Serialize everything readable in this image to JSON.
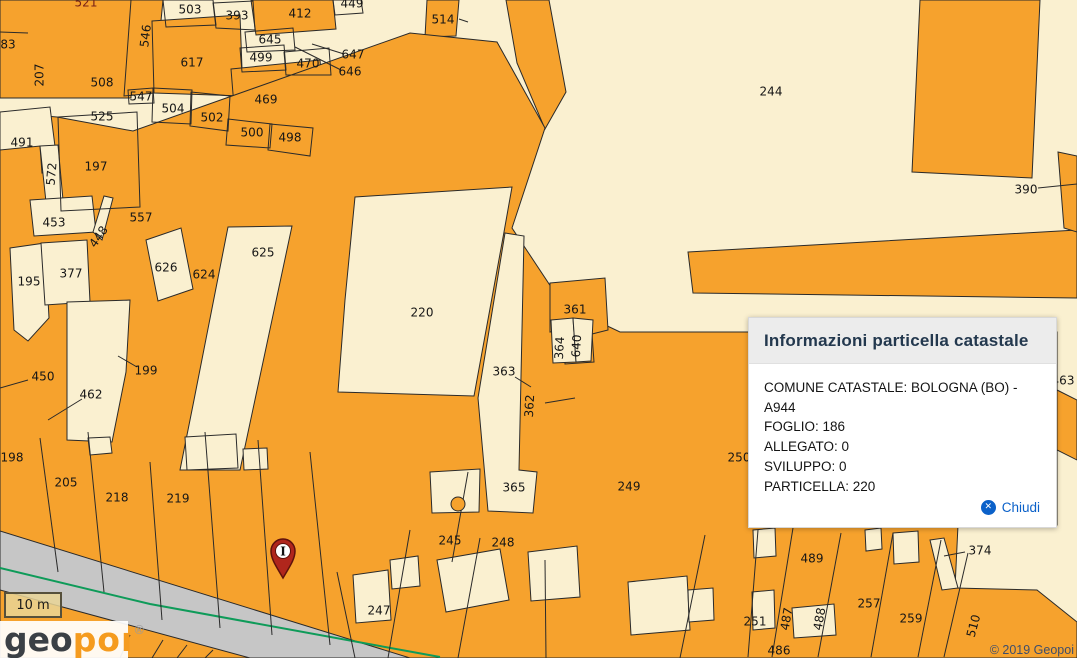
{
  "info_panel": {
    "title": "Informazioni particella catastale",
    "lines": [
      "COMUNE CATASTALE: BOLOGNA (BO) - A944",
      "FOGLIO: 186",
      "ALLEGATO: 0",
      "SVILUPPO: 0",
      "PARTICELLA: 220"
    ],
    "close_label": "Chiudi",
    "close_icon": "circle-x-icon",
    "accent_color": "#0B61C9"
  },
  "scale_bar": {
    "label": "10 m"
  },
  "logo": {
    "part1": "geo",
    "part2": "poı",
    "reg": "®"
  },
  "copyright": "© 2019 Geopoi",
  "map": {
    "colors": {
      "orange": "#F6A22D",
      "cream": "#FAF0D0",
      "stroke": "#2A2A2A",
      "road": "#C6C6C6",
      "green": "#0E9B59",
      "label": "#161616",
      "pin": "#B0261C",
      "pin_dark": "#5F120C"
    },
    "orange_polys": [
      {
        "id": "parcel-block-topleft",
        "pts": "0,0 131,0 131,98 0,98"
      },
      {
        "id": "parcel-546",
        "pts": "131,0 163,0 154,93 124,96"
      },
      {
        "id": "parcel-617",
        "pts": "152,21 240,15 243,96 154,93"
      },
      {
        "id": "parcel-412",
        "pts": "251,0 333,0 336,29 256,35"
      },
      {
        "id": "parcel-469",
        "pts": "231,69 320,60 326,127 236,131"
      },
      {
        "id": "parcel-514",
        "pts": "427,0 459,0 456,36 425,37"
      },
      {
        "id": "parcel-strip-ne",
        "pts": "506,0 549,0 566,92 545,129 517,63"
      },
      {
        "id": "parcel-main-block",
        "pts": "0,112 57,117 133,131 410,33 497,42 545,128 512,228 563,305 620,332 1057,332 1057,525 958,525 955,588 1037,590 1077,622 1077,658 0,658"
      },
      {
        "id": "parcel-band-244",
        "pts": "688,252 1077,230 1077,298 693,293"
      },
      {
        "id": "building-244",
        "pts": "920,0 1040,0 1032,178 912,172"
      },
      {
        "id": "parcel-390-edge",
        "pts": "1058,152 1077,156 1077,232 1064,228"
      },
      {
        "id": "parcel-361",
        "pts": "550,283 605,278 608,330 592,334 594,362 565,364 563,330 550,332"
      },
      {
        "id": "parcel-463-sliver",
        "pts": "1057,390 1077,400 1077,460 1057,450"
      }
    ],
    "cream_polys": [
      {
        "id": "parcel-491",
        "pts": "0,112 50,107 58,170 42,173 40,146 0,150"
      },
      {
        "id": "parcel-572",
        "pts": "40,146 58,145 63,200 46,202"
      },
      {
        "id": "parcel-453",
        "pts": "30,200 92,196 96,232 34,236"
      },
      {
        "id": "parcel-448",
        "pts": "93,232 104,196 113,198 102,240"
      },
      {
        "id": "parcel-195",
        "pts": "10,248 45,243 49,318 28,341 14,330"
      },
      {
        "id": "parcel-377",
        "pts": "41,243 87,240 90,302 45,305"
      },
      {
        "id": "building-626",
        "pts": "146,240 181,228 193,289 158,301"
      },
      {
        "id": "parcel-625",
        "pts": "228,227 292,226 240,470 180,470 194,400"
      },
      {
        "id": "parcel-199",
        "pts": "67,302 130,300 126,372 112,442 67,440"
      },
      {
        "id": "parcel-220",
        "pts": "355,197 512,187 504,232 474,396 338,392 345,300"
      },
      {
        "id": "parcel-362-365",
        "pts": "505,233 524,236 519,470 537,472 533,513 488,511 478,398"
      },
      {
        "id": "parcel-364",
        "pts": "551,320 573,318 576,362 553,363"
      },
      {
        "id": "parcel-640",
        "pts": "573,318 593,320 591,361 576,362"
      },
      {
        "id": "building-a",
        "pts": "88,438 110,437 112,453 90,455"
      },
      {
        "id": "building-b",
        "pts": "185,437 236,434 238,468 187,470"
      },
      {
        "id": "building-c",
        "pts": "243,449 267,448 268,469 244,470"
      },
      {
        "id": "building-245",
        "pts": "430,472 480,469 479,512 432,513"
      },
      {
        "id": "building-e",
        "pts": "437,560 500,549 509,600 446,612"
      },
      {
        "id": "building-f",
        "pts": "390,560 418,556 420,586 392,589"
      },
      {
        "id": "building-g",
        "pts": "353,575 388,570 391,620 356,623"
      },
      {
        "id": "building-h",
        "pts": "528,552 577,546 580,597 531,601"
      },
      {
        "id": "building-i",
        "pts": "628,582 687,576 690,630 631,635"
      },
      {
        "id": "building-j",
        "pts": "688,590 713,588 714,620 689,622"
      },
      {
        "id": "building-k",
        "pts": "753,530 775,528 776,556 754,558"
      },
      {
        "id": "building-l",
        "pts": "752,592 774,590 775,628 753,630"
      },
      {
        "id": "building-m",
        "pts": "792,608 834,604 836,635 794,638"
      },
      {
        "id": "building-n",
        "pts": "865,530 881,528 882,549 866,551"
      },
      {
        "id": "building-o",
        "pts": "893,533 918,531 919,562 894,564"
      },
      {
        "id": "parcel-374-strip",
        "pts": "930,540 944,538 958,588 942,590"
      }
    ],
    "outline_polys": [
      {
        "id": "parcel-503",
        "pts": "163,0 213,0 216,25 166,27"
      },
      {
        "id": "parcel-393",
        "pts": "213,3 253,1 255,30 216,28"
      },
      {
        "id": "parcel-645",
        "pts": "245,32 293,28 295,50 247,52"
      },
      {
        "id": "parcel-499",
        "pts": "240,48 284,45 286,70 242,72"
      },
      {
        "id": "parcel-470",
        "pts": "284,52 329,48 331,75 286,75"
      },
      {
        "id": "parcel-449",
        "pts": "333,0 361,0 363,13 335,15"
      },
      {
        "id": "parcel-547",
        "pts": "128,90 153,88 154,103 129,104"
      },
      {
        "id": "parcel-504",
        "pts": "153,88 192,90 191,124 152,122"
      },
      {
        "id": "parcel-502",
        "pts": "191,92 230,96 228,131 190,126"
      },
      {
        "id": "parcel-500",
        "pts": "228,119 272,124 270,148 226,145"
      },
      {
        "id": "parcel-498",
        "pts": "270,124 313,128 310,156 268,150"
      },
      {
        "id": "parcel-197",
        "pts": "58,117 137,112 140,207 61,211"
      }
    ],
    "lines": [
      "0,32 28,33",
      "40,438 58,572",
      "88,432 104,592",
      "150,462 162,620",
      "205,432 220,628",
      "258,440 272,635",
      "310,452 330,645",
      "337,572 355,658",
      "410,530 388,658",
      "480,538 458,658",
      "545,560 546,658",
      "468,472 452,562",
      "705,535 680,658",
      "758,530 748,657",
      "793,528 772,657",
      "841,533 818,657",
      "893,533 871,657",
      "941,540 918,657",
      "968,553 944,657",
      "130,635 120,658",
      "163,640 152,658",
      "187,645 177,658",
      "213,650 205,658",
      "344,54 312,44",
      "341,70 295,47",
      "1038,188 1077,184",
      "944,556 965,552",
      "515,377 531,387",
      "545,403 575,398",
      "137,367 118,356",
      "28,380 0,388",
      "82,399 48,420",
      "459,19 468,22"
    ],
    "road": {
      "poly": "0,531 410,658 250,658 0,590",
      "green": "0,568 150,604 440,657"
    },
    "labels": [
      {
        "t": "521",
        "x": 86,
        "y": 3,
        "c": "#7a2317"
      },
      {
        "t": "83",
        "x": 8,
        "y": 45
      },
      {
        "t": "207",
        "x": 40,
        "y": 75,
        "r": -90
      },
      {
        "t": "508",
        "x": 102,
        "y": 83
      },
      {
        "t": "546",
        "x": 146,
        "y": 36,
        "r": -83
      },
      {
        "t": "503",
        "x": 190,
        "y": 10
      },
      {
        "t": "393",
        "x": 237,
        "y": 16
      },
      {
        "t": "412",
        "x": 300,
        "y": 14
      },
      {
        "t": "645",
        "x": 270,
        "y": 40
      },
      {
        "t": "499",
        "x": 261,
        "y": 58
      },
      {
        "t": "470",
        "x": 308,
        "y": 64
      },
      {
        "t": "647",
        "x": 353,
        "y": 55
      },
      {
        "t": "646",
        "x": 350,
        "y": 72
      },
      {
        "t": "617",
        "x": 192,
        "y": 63
      },
      {
        "t": "469",
        "x": 266,
        "y": 100
      },
      {
        "t": "547",
        "x": 141,
        "y": 97
      },
      {
        "t": "504",
        "x": 173,
        "y": 109
      },
      {
        "t": "502",
        "x": 212,
        "y": 118
      },
      {
        "t": "500",
        "x": 252,
        "y": 133
      },
      {
        "t": "498",
        "x": 290,
        "y": 138
      },
      {
        "t": "525",
        "x": 102,
        "y": 117
      },
      {
        "t": "491",
        "x": 22,
        "y": 143
      },
      {
        "t": "572",
        "x": 52,
        "y": 174,
        "r": -85
      },
      {
        "t": "197",
        "x": 96,
        "y": 167
      },
      {
        "t": "557",
        "x": 141,
        "y": 218
      },
      {
        "t": "453",
        "x": 54,
        "y": 223
      },
      {
        "t": "448",
        "x": 99,
        "y": 237,
        "r": -55
      },
      {
        "t": "449",
        "x": 352,
        "y": 4
      },
      {
        "t": "514",
        "x": 443,
        "y": 20
      },
      {
        "t": "195",
        "x": 29,
        "y": 282
      },
      {
        "t": "377",
        "x": 71,
        "y": 274
      },
      {
        "t": "626",
        "x": 166,
        "y": 268
      },
      {
        "t": "624",
        "x": 204,
        "y": 275
      },
      {
        "t": "625",
        "x": 263,
        "y": 253
      },
      {
        "t": "199",
        "x": 146,
        "y": 371
      },
      {
        "t": "450",
        "x": 43,
        "y": 377
      },
      {
        "t": "462",
        "x": 91,
        "y": 395
      },
      {
        "t": "198",
        "x": 12,
        "y": 458
      },
      {
        "t": "205",
        "x": 66,
        "y": 483
      },
      {
        "t": "218",
        "x": 117,
        "y": 498
      },
      {
        "t": "219",
        "x": 178,
        "y": 499
      },
      {
        "t": "220",
        "x": 422,
        "y": 313
      },
      {
        "t": "361",
        "x": 575,
        "y": 310
      },
      {
        "t": "364",
        "x": 560,
        "y": 348,
        "r": -87
      },
      {
        "t": "640",
        "x": 577,
        "y": 346,
        "r": -87
      },
      {
        "t": "363",
        "x": 504,
        "y": 372
      },
      {
        "t": "362",
        "x": 530,
        "y": 406,
        "r": -87
      },
      {
        "t": "365",
        "x": 514,
        "y": 488
      },
      {
        "t": "249",
        "x": 629,
        "y": 487
      },
      {
        "t": "250",
        "x": 739,
        "y": 458
      },
      {
        "t": "244",
        "x": 771,
        "y": 92
      },
      {
        "t": "390",
        "x": 1026,
        "y": 190
      },
      {
        "t": "463",
        "x": 1063,
        "y": 381
      },
      {
        "t": "245",
        "x": 450,
        "y": 541
      },
      {
        "t": "248",
        "x": 503,
        "y": 543
      },
      {
        "t": "247",
        "x": 379,
        "y": 611
      },
      {
        "t": "489",
        "x": 812,
        "y": 559
      },
      {
        "t": "374",
        "x": 980,
        "y": 551
      },
      {
        "t": "257",
        "x": 869,
        "y": 604
      },
      {
        "t": "259",
        "x": 911,
        "y": 619
      },
      {
        "t": "251",
        "x": 755,
        "y": 622
      },
      {
        "t": "487",
        "x": 787,
        "y": 619,
        "r": -80
      },
      {
        "t": "488",
        "x": 820,
        "y": 619,
        "r": -80
      },
      {
        "t": "486",
        "x": 779,
        "y": 651
      },
      {
        "t": "510",
        "x": 974,
        "y": 626,
        "r": -75
      }
    ],
    "marker": {
      "x": 283,
      "y": 578,
      "glyph": "I"
    },
    "small_circle": {
      "x": 458,
      "y": 504,
      "r": 7
    }
  }
}
